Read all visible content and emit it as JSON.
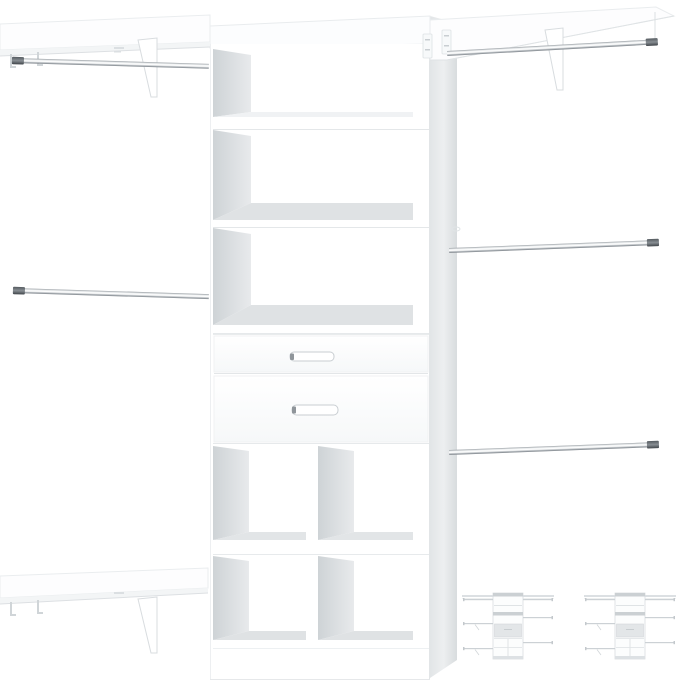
{
  "image": {
    "subject": "white wall-mounted closet organizer system with center tower, drawers, cubbies, shelves and chrome hanging rods",
    "colors": {
      "background": "#ffffff",
      "panel_white": "#ffffff",
      "panel_tint": "#fcfdfe",
      "side_panel": "#e4e7e9",
      "inner_wall_dark": "#ced3d6",
      "inner_wall_light": "#e8eaec",
      "floor_shadow": "#dfe2e4",
      "floor_shadow_light": "#f0f2f4",
      "edge_line": "#e6e9eb",
      "rod_highlight": "#f2f4f5",
      "rod_shadow": "#7e848a",
      "rod_cap": "#4e5357",
      "bracket_line": "#d8dcdf",
      "handle_outline": "#c9ced2",
      "handle_cap": "#8f959a",
      "thumbnail_line": "#ccd1d5"
    },
    "components": {
      "tower": {
        "open_shelf_compartments": 3,
        "drawers": 2,
        "drawer_handles": 2,
        "cubbies": 4
      },
      "left_section": {
        "shelves": 2,
        "hanging_rods": 2
      },
      "right_section": {
        "shelves": 1,
        "hanging_rods": 3
      },
      "hanging_rods_total": 5,
      "variant_thumbnails": 2
    }
  }
}
